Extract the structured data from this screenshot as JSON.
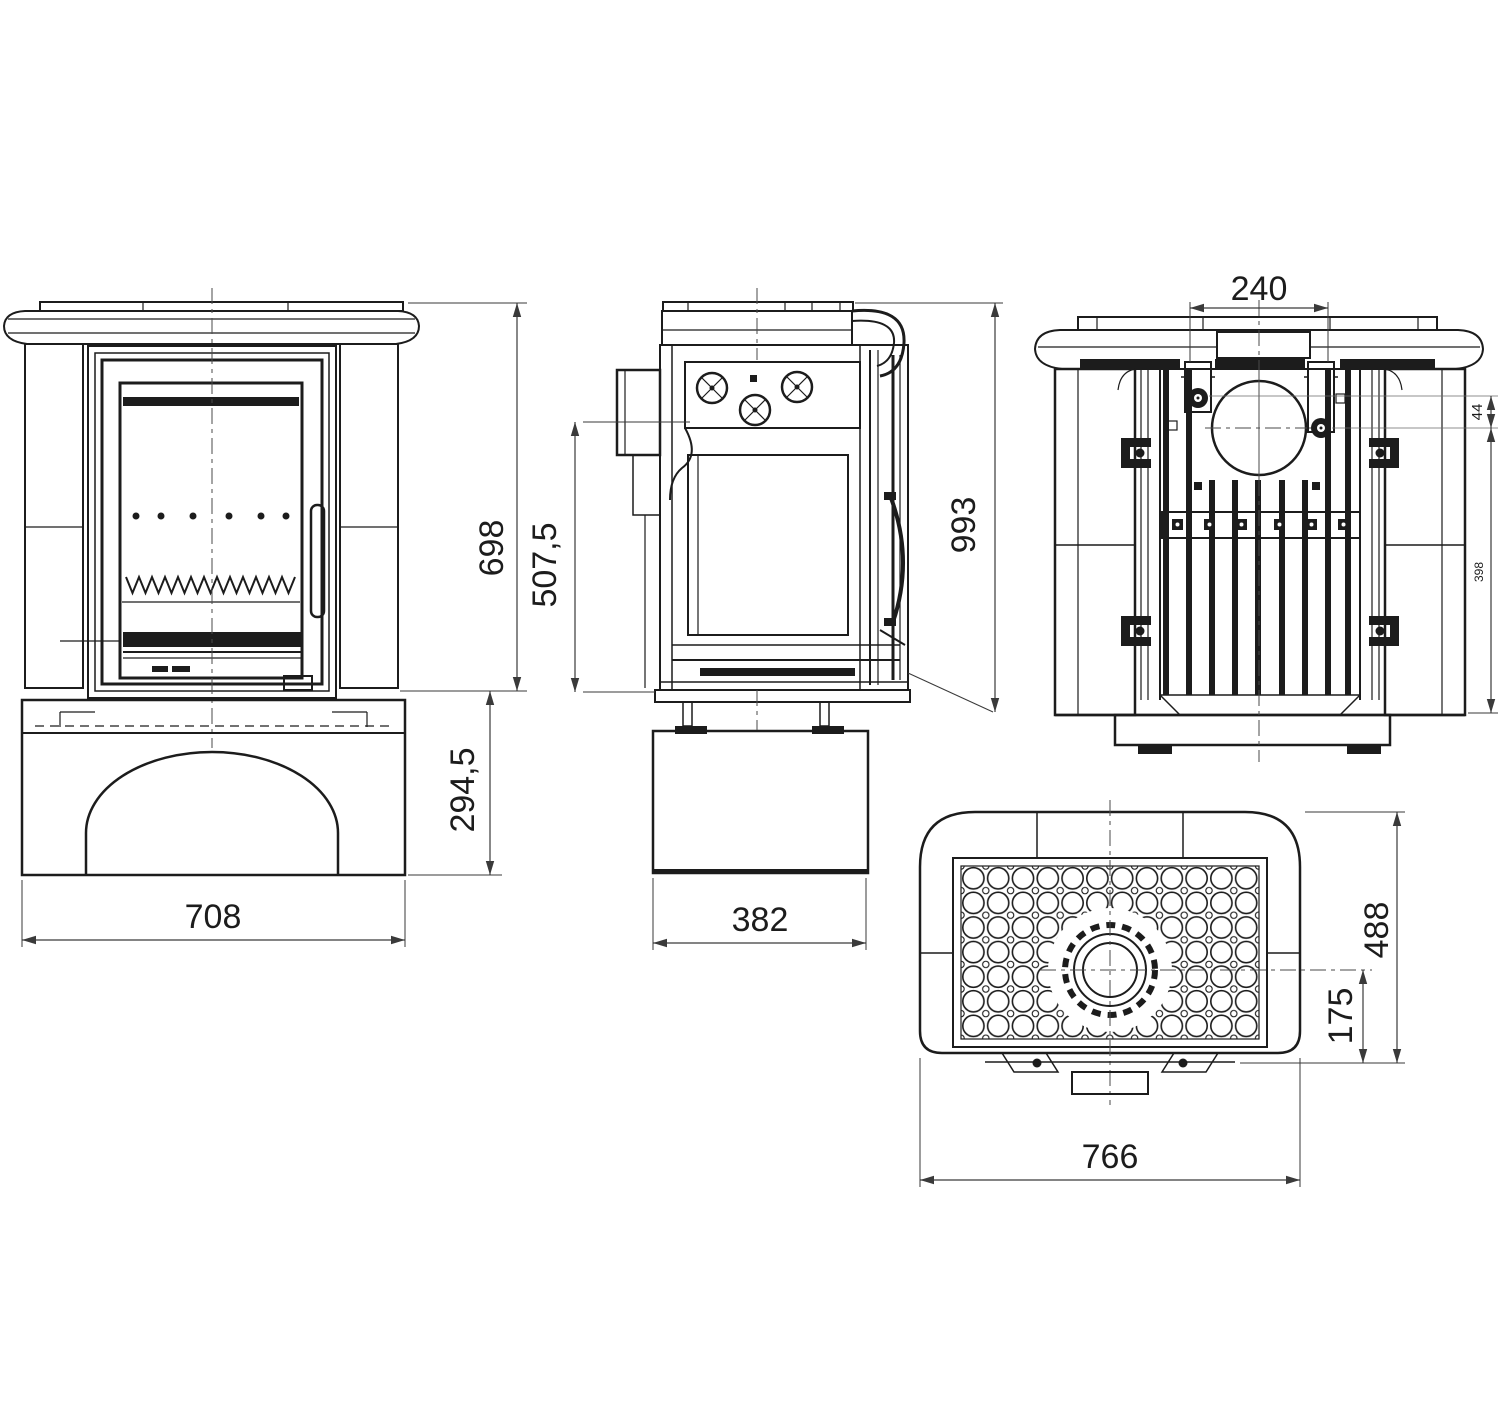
{
  "drawing": {
    "type": "stove-dimensional-drawing",
    "colors": {
      "background": "#ffffff",
      "line": "#1c1c1c",
      "dimension": "#3a3a3a"
    },
    "views": {
      "front": {
        "id": "front-view",
        "dim_width": "708",
        "dim_upper_height": "698",
        "dim_base_height": "294,5"
      },
      "side": {
        "id": "side-view",
        "dim_depth": "382",
        "dim_total_height": "993",
        "dim_flue_height": "507,5"
      },
      "rear": {
        "id": "rear-view",
        "dim_flue_spacing": "240",
        "dim_offset": "44",
        "dim_lower_height": "398"
      },
      "top": {
        "id": "top-view",
        "dim_width": "766",
        "dim_depth": "488",
        "dim_flue_to_rear": "175"
      }
    }
  }
}
